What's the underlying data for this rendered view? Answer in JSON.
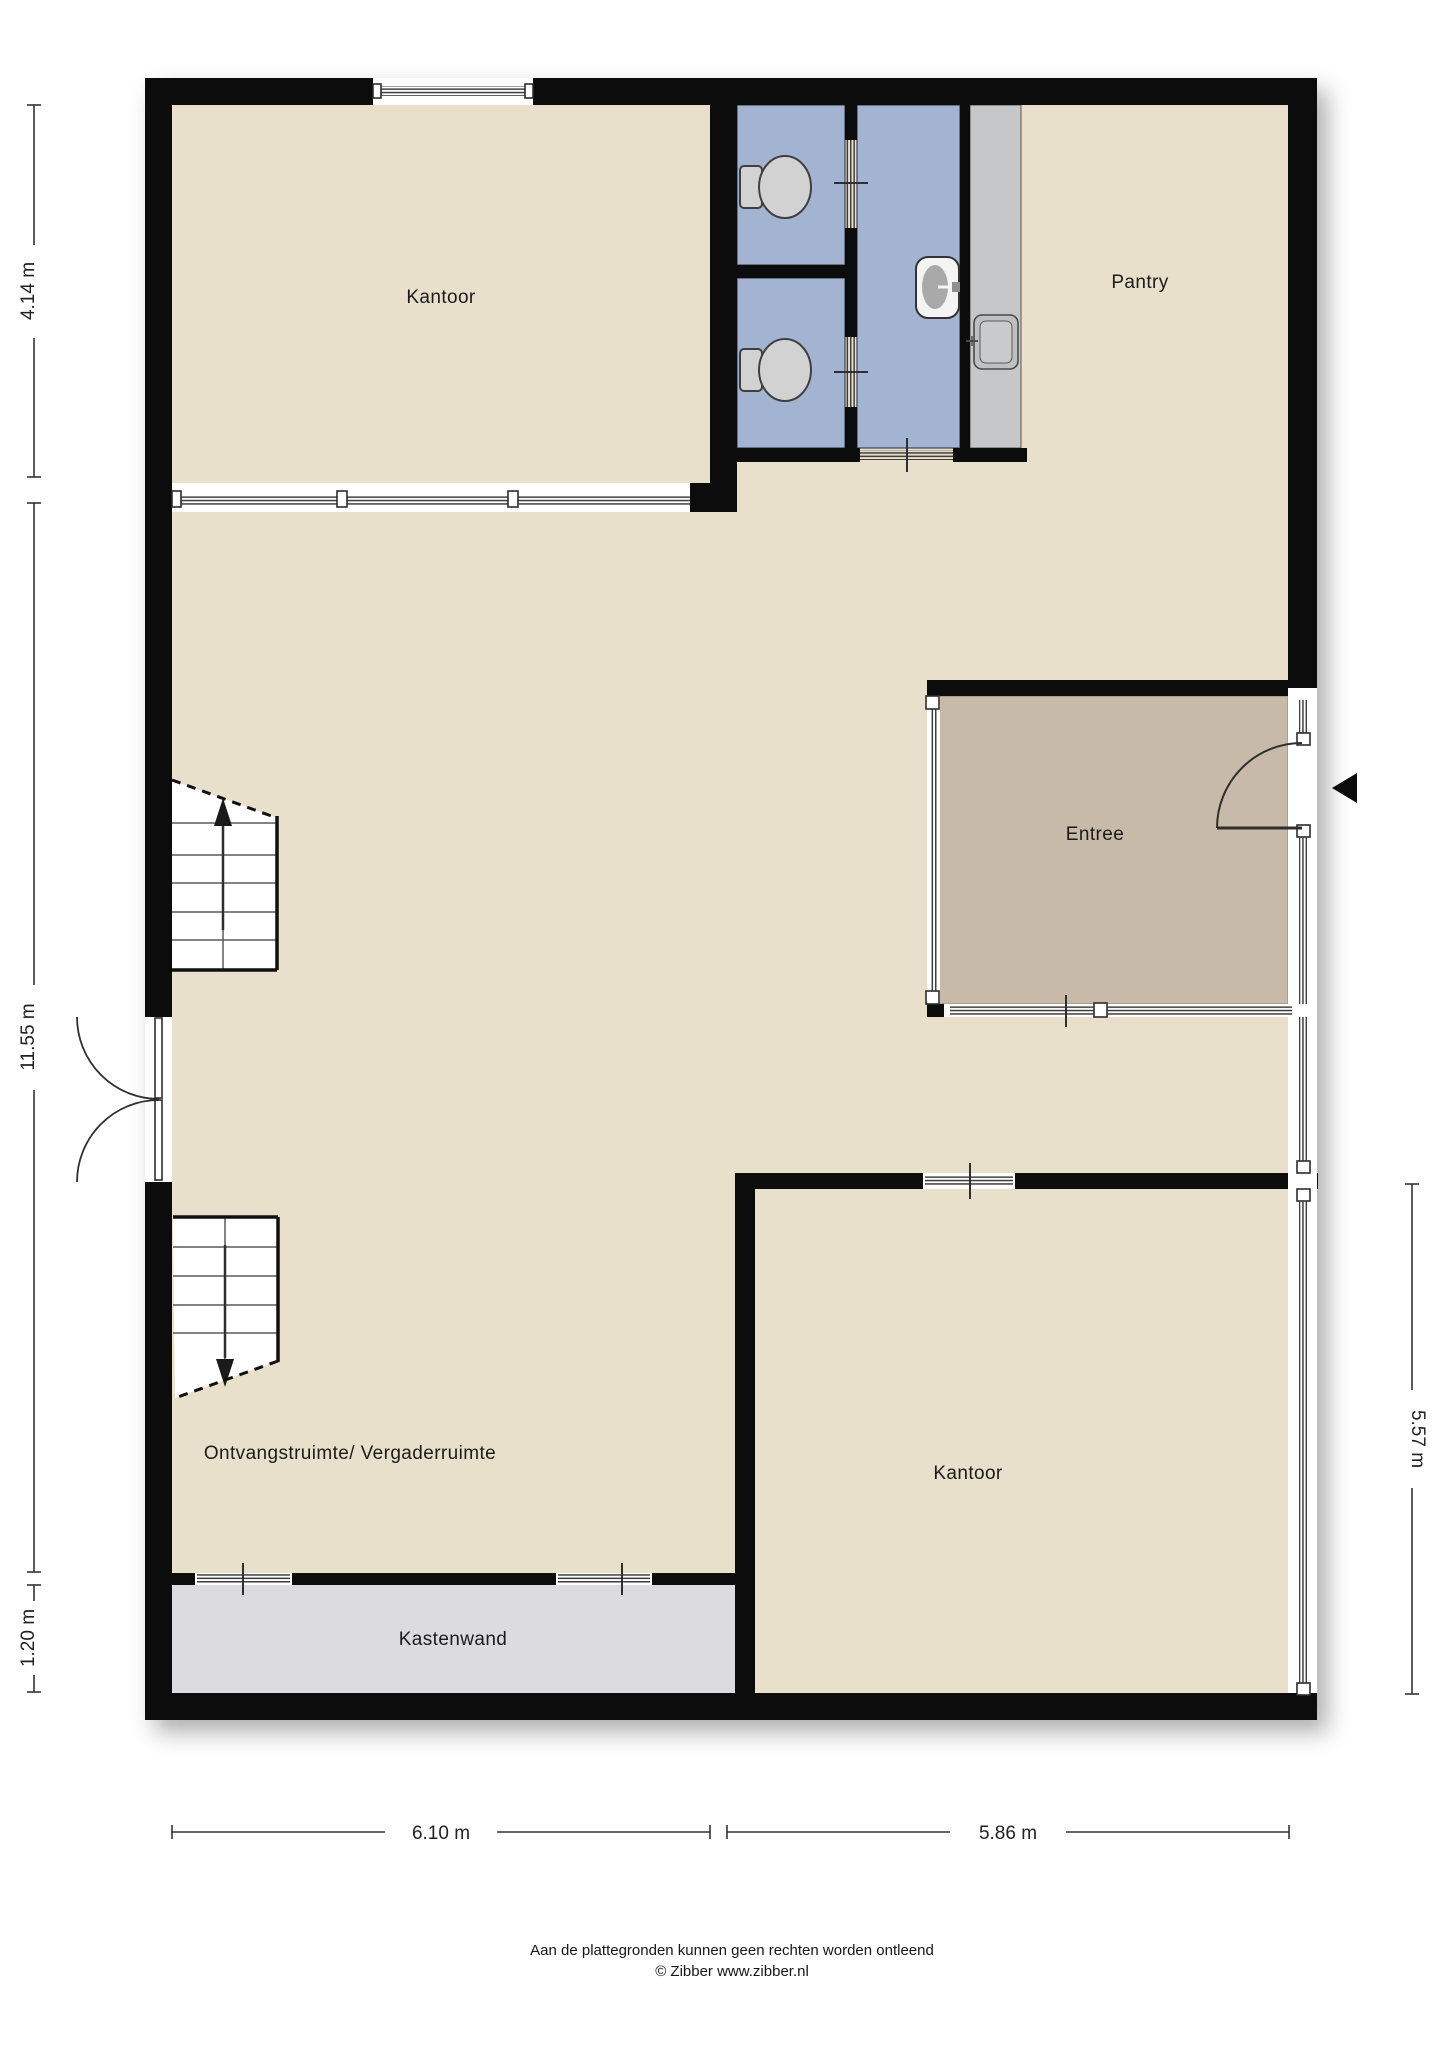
{
  "rooms": {
    "kantoor_top": "Kantoor",
    "pantry": "Pantry",
    "entree": "Entree",
    "ontvangstruimte": "Ontvangstruimte/ Vergaderruimte",
    "kantoor_bottom": "Kantoor",
    "kastenwand": "Kastenwand"
  },
  "dimensions": {
    "left_top": "4.14 m",
    "left_middle": "11.55 m",
    "left_bottom": "1.20 m",
    "right_side": "5.57 m",
    "bottom_left": "6.10 m",
    "bottom_right": "5.86 m"
  },
  "footer": {
    "line1": "Aan de plattegronden kunnen geen rechten worden ontleend",
    "line2": "© Zibber www.zibber.nl"
  },
  "icons": [
    "toilet-icon",
    "toilet-icon",
    "washbasin-icon",
    "kitchen-sink-icon",
    "stairs-up-icon",
    "stairs-down-icon",
    "double-door-icon",
    "entrance-door-icon",
    "entrance-arrow-icon",
    "window-icon"
  ],
  "colors": {
    "wall": "#0c0c0c",
    "floor": "#e8e0ca",
    "wet": "#a3b4d3",
    "counter": "#c6c7c9",
    "entree": "#c7baa8",
    "closet": "#dcdce0",
    "fixture": "#d2d2d2"
  }
}
